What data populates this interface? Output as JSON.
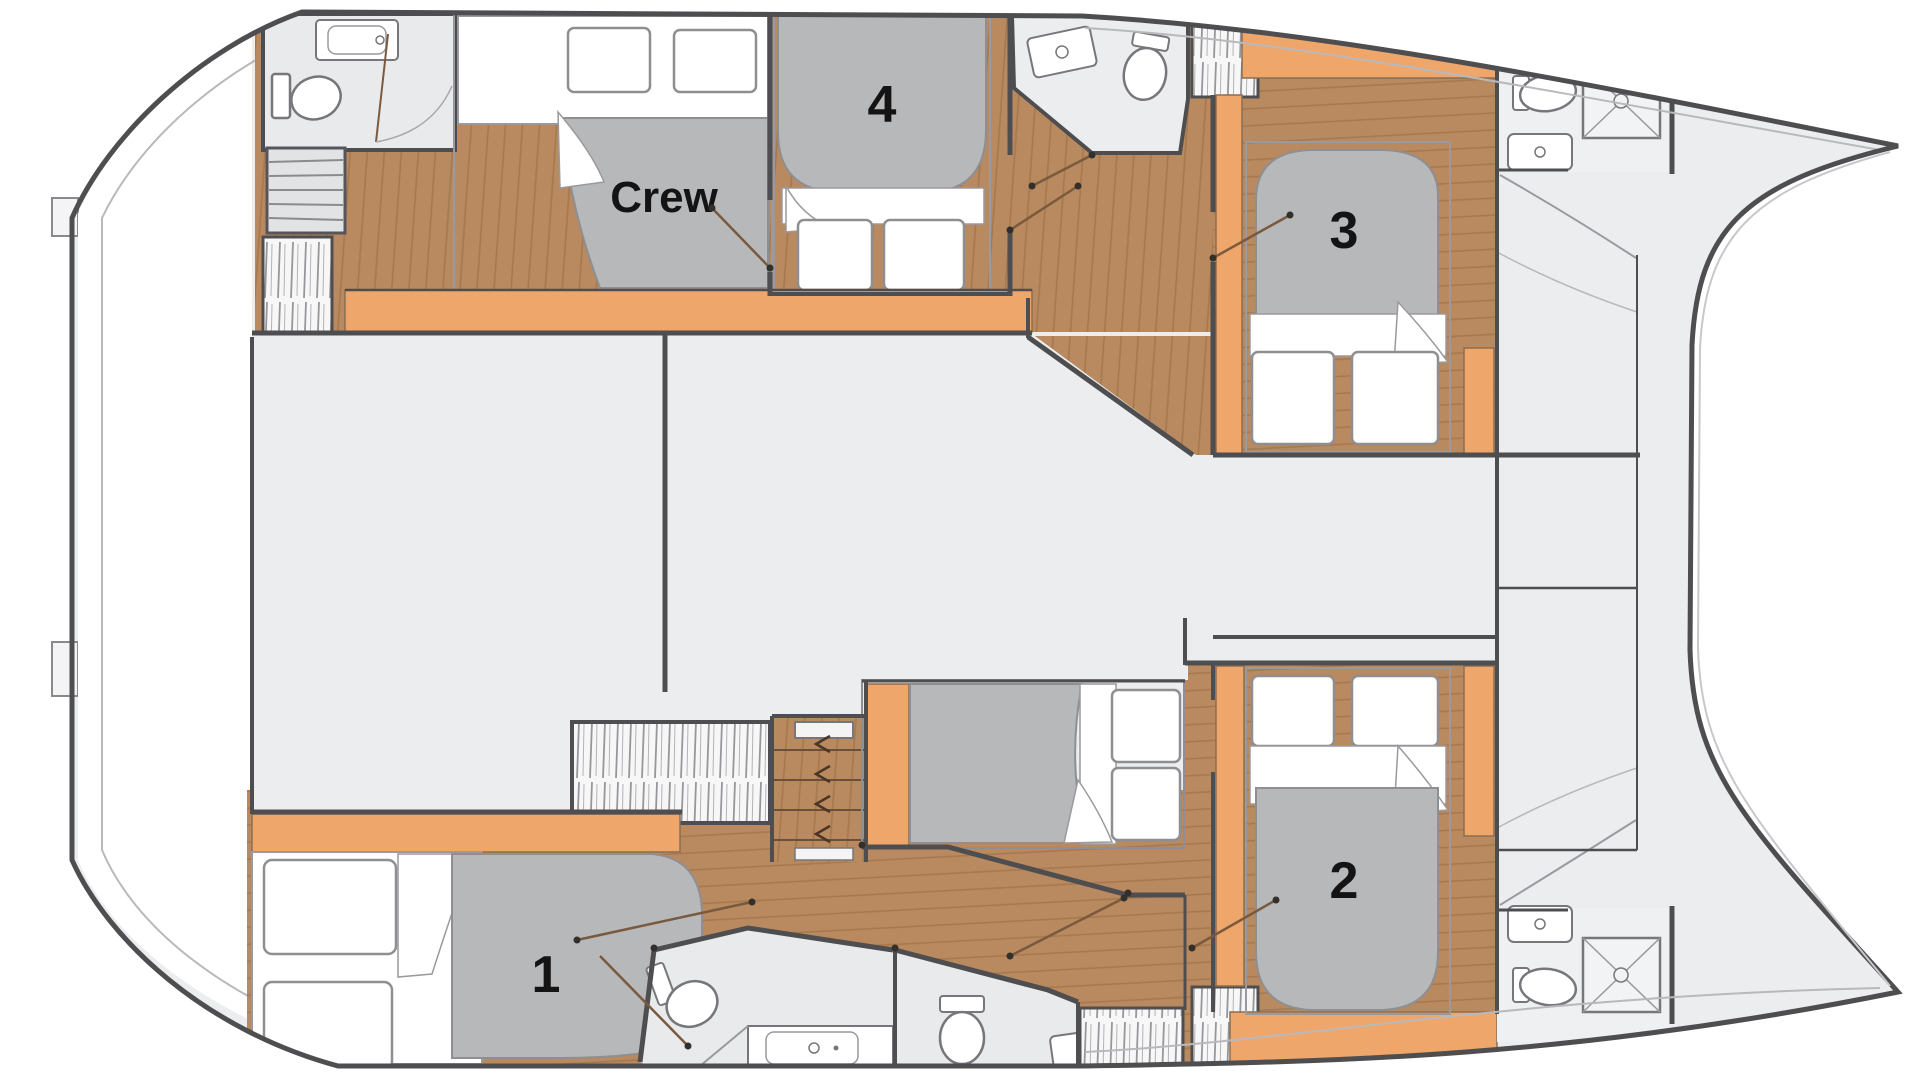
{
  "floorplan": {
    "type": "catamaran-deck-layout",
    "labels": {
      "cabin1": "1",
      "cabin2": "2",
      "cabin3": "3",
      "cabin4": "4",
      "crew": "Crew"
    },
    "colors": {
      "deck": "#ecedee",
      "hull_outline": "#4e4e50",
      "wood": "#b9895f",
      "wood_line": "#a5784e",
      "accent_orange": "#efa66b",
      "bed_gray": "#b7b8ba",
      "bathroom": "#e9eaec",
      "wall": "#4e4e50",
      "door_line": "#7a5a3e",
      "hatch_line": "#97979b",
      "white": "#ffffff"
    }
  }
}
